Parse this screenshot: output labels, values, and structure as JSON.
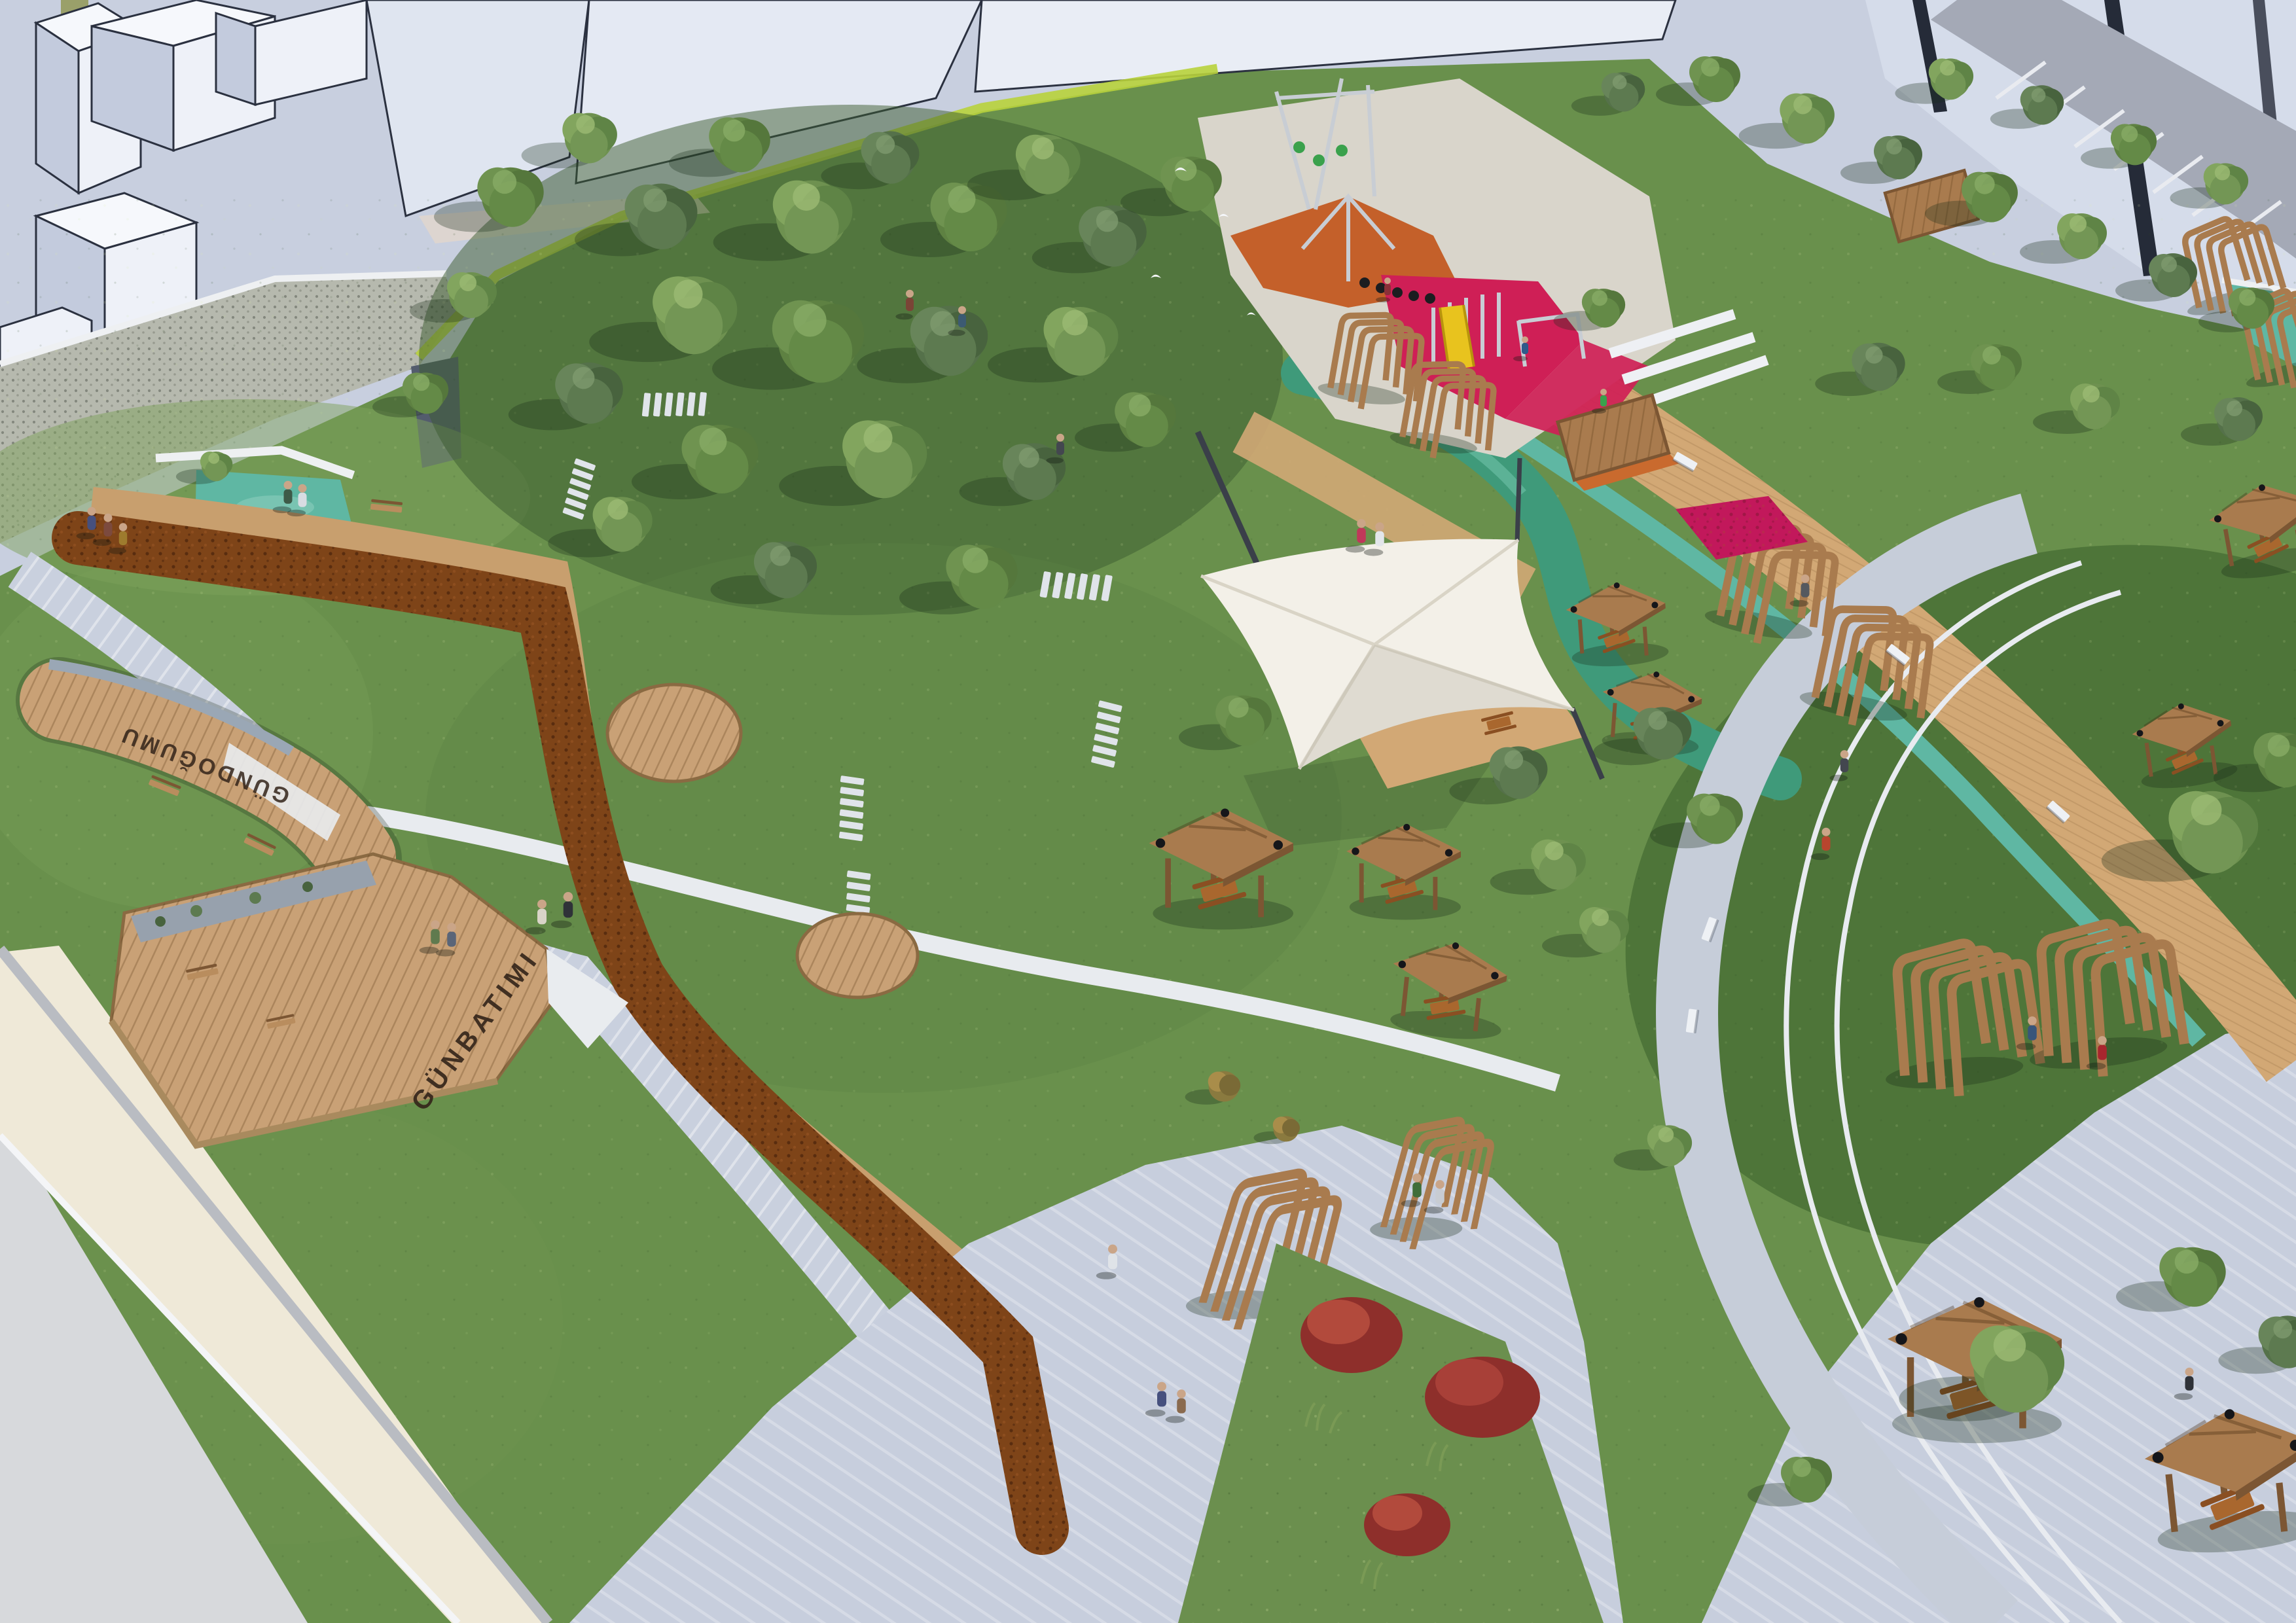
{
  "terraces": {
    "sunrise_deck_label": "GÜNDOĞUMU",
    "sunset_deck_label": "GÜNBATIMI"
  },
  "palette": {
    "plaza": "#c8cfdf",
    "bFace": "#eef1f8",
    "bSide": "#c3cbdd",
    "bTop": "#f6f8fc",
    "bLine": "#2b3140",
    "glass": "#252b38",
    "asphalt": "#a4a9b6",
    "gabion": "#b6b9ae",
    "lime": "#b8d23c",
    "grass": "#69904c",
    "grassLight": "#7da25c",
    "grassDark": "#3c5c2f",
    "ovalGrass": "#4e7539",
    "hedge": "#7e4418",
    "tanPath": "#c89f6e",
    "boardwalk": "#d2a875",
    "deckWood": "#c9a176",
    "woodFrame": "#a97b4e",
    "woodDark": "#7c5633",
    "benchWood": "#b98d5e",
    "stripedPale": "#c9d0de",
    "whitePath": "#e8ebef",
    "poolEdge": "#eef0f2",
    "waterTeal": "#5fb7a3",
    "waterGreen": "#3f9a7a",
    "canopy": "#f3f0e8",
    "matOrange": "#c4602a",
    "matPink": "#cf1f56",
    "magenta": "#c2185b",
    "slideYellow": "#e8c31e",
    "redBush": "#8e2f2b",
    "cream": "#efe9d8",
    "sidewalk": "#d7d9dc"
  }
}
